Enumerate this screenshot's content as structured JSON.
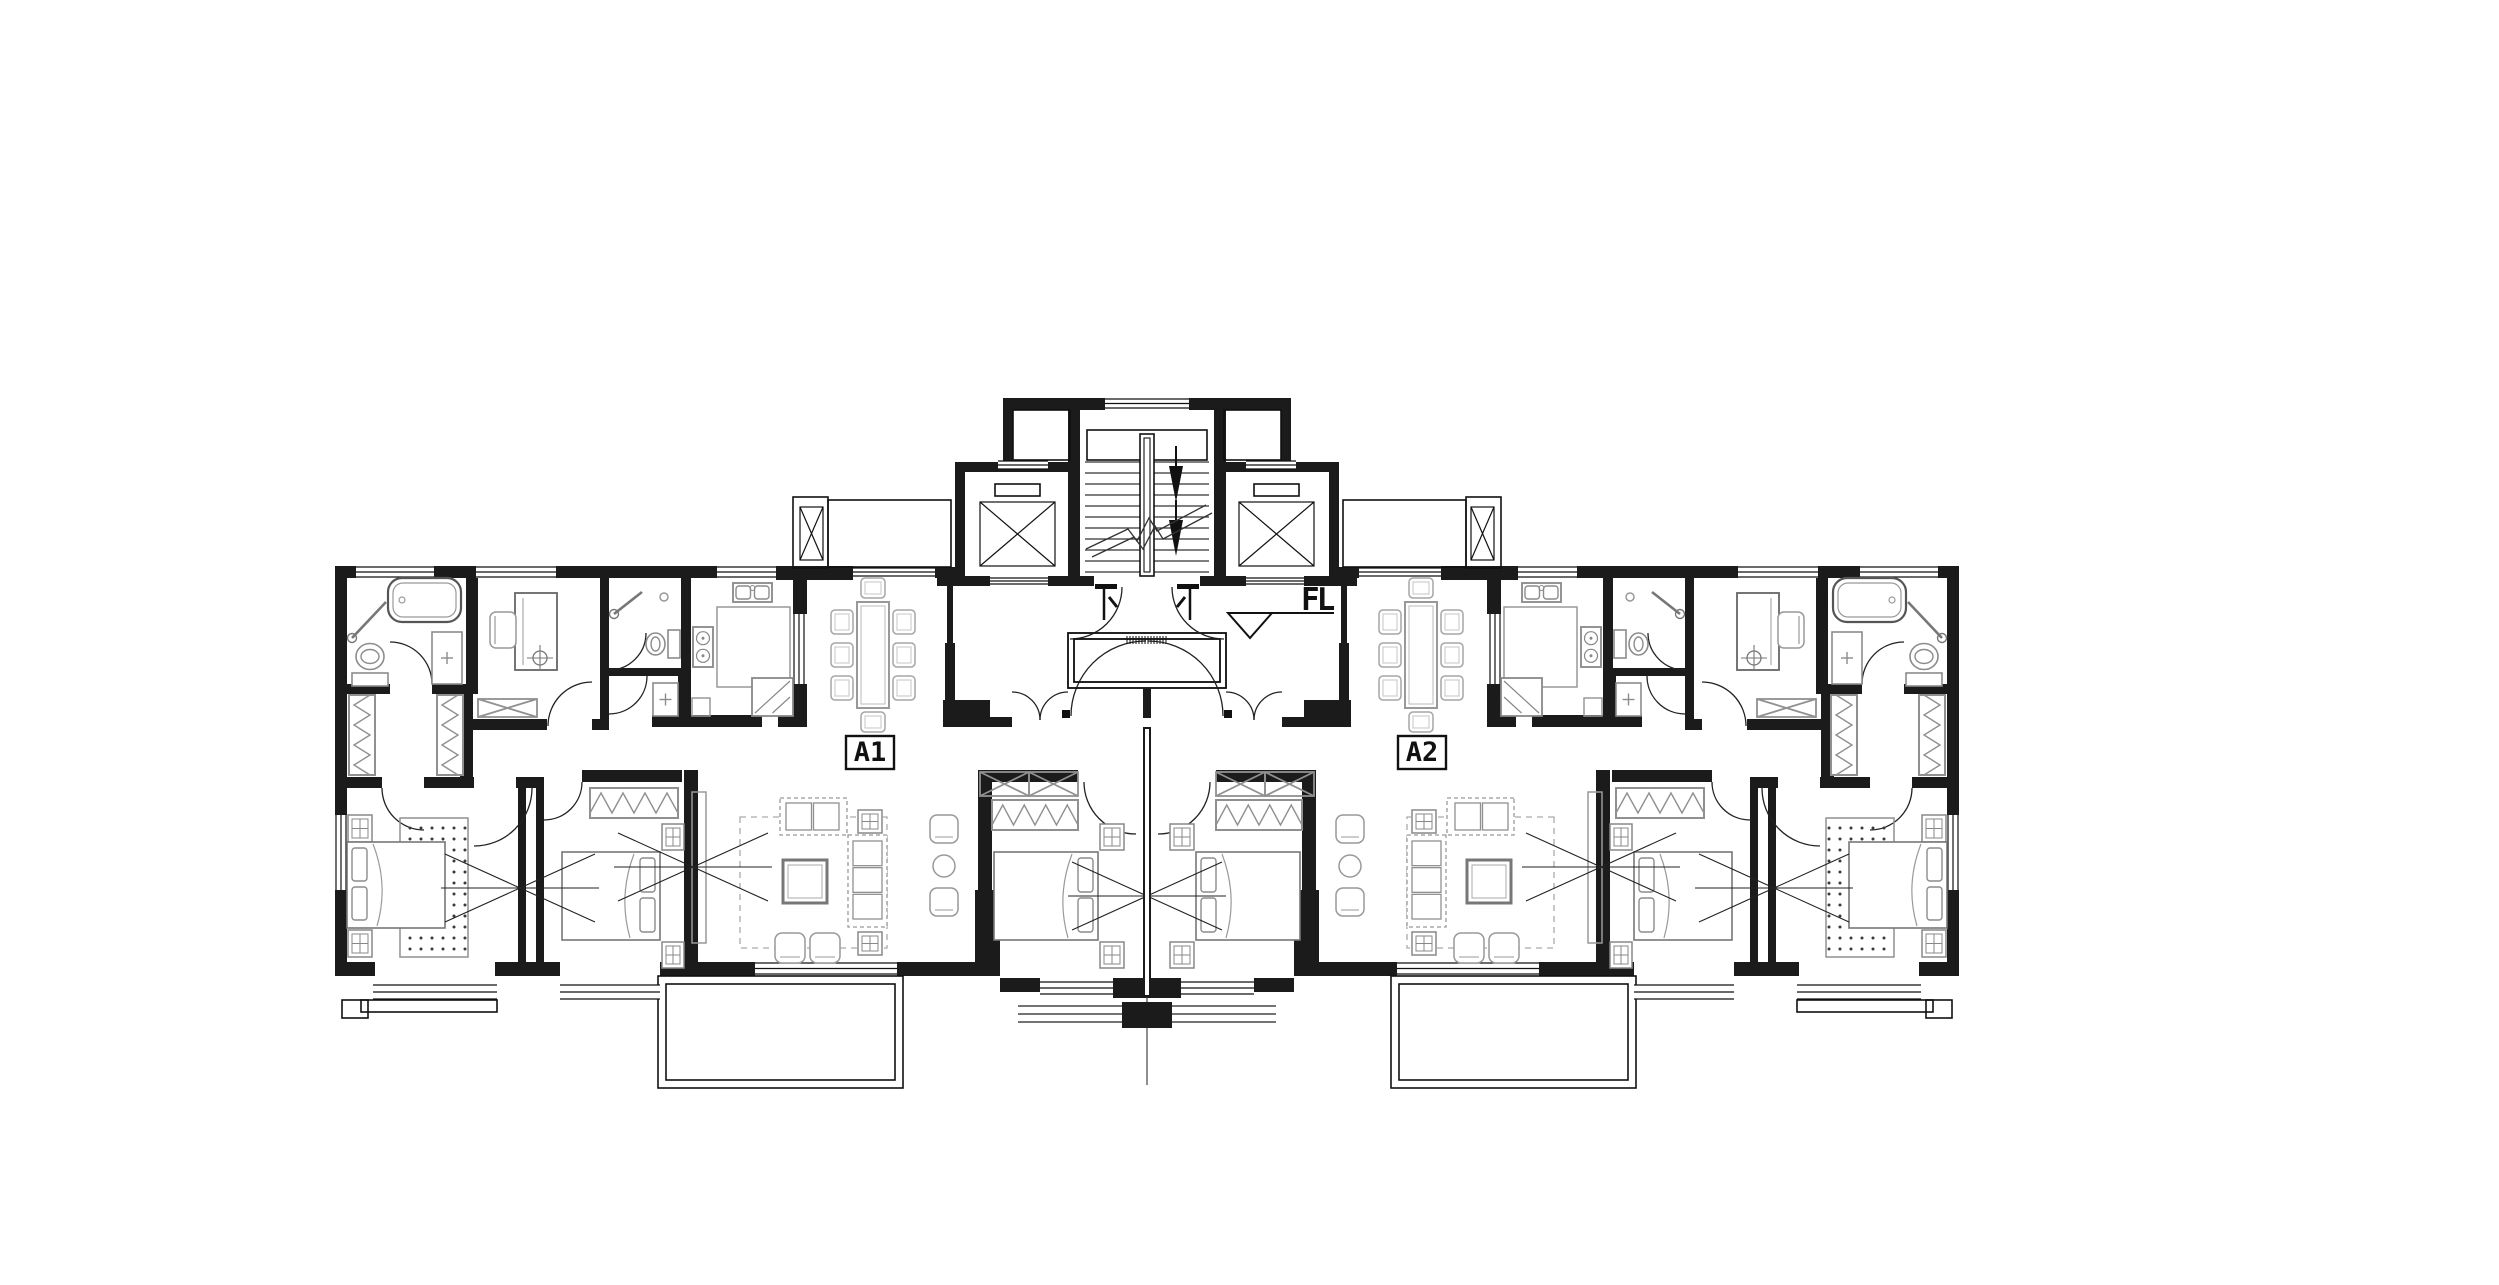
{
  "canvas": {
    "w": 2499,
    "h": 1285
  },
  "labels": {
    "unit_left": "A1",
    "unit_right": "A2",
    "floor_core": "FL"
  },
  "colors": {
    "wall": "#1b1b1b",
    "line": "#111111",
    "furn": "#8c8c8c",
    "furn_dark": "#666666",
    "bg": "#ffffff"
  },
  "plan": {
    "mirror_axis": 1147,
    "walls": [
      [
        335,
        566,
        21,
        12
      ],
      [
        434,
        566,
        42,
        12
      ],
      [
        556,
        566,
        53,
        12
      ],
      [
        609,
        566,
        72,
        12
      ],
      [
        681,
        566,
        36,
        12
      ],
      [
        776,
        566,
        77,
        14
      ],
      [
        935,
        567,
        23,
        11
      ],
      [
        335,
        566,
        12,
        249
      ],
      [
        335,
        890,
        12,
        86
      ],
      [
        466,
        578,
        12,
        116
      ],
      [
        335,
        684,
        55,
        10
      ],
      [
        432,
        684,
        34,
        10
      ],
      [
        460,
        694,
        13,
        94
      ],
      [
        347,
        777,
        35,
        11
      ],
      [
        424,
        777,
        50,
        11
      ],
      [
        516,
        777,
        28,
        11
      ],
      [
        600,
        578,
        9,
        152
      ],
      [
        466,
        719,
        81,
        11
      ],
      [
        592,
        719,
        8,
        11
      ],
      [
        609,
        668,
        72,
        8
      ],
      [
        678,
        676,
        13,
        51
      ],
      [
        652,
        715,
        39,
        12
      ],
      [
        681,
        578,
        10,
        149
      ],
      [
        681,
        715,
        81,
        12
      ],
      [
        793,
        566,
        14,
        48
      ],
      [
        793,
        684,
        14,
        43
      ],
      [
        945,
        717,
        67,
        10
      ],
      [
        943,
        700,
        47,
        27
      ],
      [
        945,
        643,
        10,
        84
      ],
      [
        947,
        586,
        6,
        57
      ],
      [
        937,
        577,
        53,
        9
      ],
      [
        955,
        462,
        123,
        10
      ],
      [
        955,
        576,
        35,
        10
      ],
      [
        1048,
        576,
        30,
        10
      ],
      [
        955,
        462,
        10,
        114
      ],
      [
        1068,
        408,
        12,
        178
      ],
      [
        1003,
        398,
        77,
        12
      ],
      [
        1003,
        398,
        10,
        72
      ],
      [
        1080,
        398,
        25,
        12
      ],
      [
        1068,
        576,
        26,
        10
      ],
      [
        778,
        700,
        27,
        27
      ],
      [
        518,
        782,
        8,
        180
      ],
      [
        536,
        782,
        8,
        180
      ],
      [
        684,
        770,
        14,
        192
      ],
      [
        582,
        770,
        100,
        12
      ],
      [
        978,
        770,
        100,
        12
      ],
      [
        975,
        890,
        25,
        86
      ],
      [
        978,
        782,
        14,
        108
      ],
      [
        335,
        962,
        40,
        14
      ],
      [
        495,
        962,
        65,
        14
      ],
      [
        660,
        962,
        95,
        14
      ],
      [
        897,
        962,
        103,
        14
      ],
      [
        1000,
        978,
        40,
        14
      ],
      [
        1113,
        978,
        38,
        20
      ]
    ],
    "thin_rects": [
      [
        793,
        497,
        35,
        71
      ],
      [
        828,
        500,
        123,
        67
      ],
      [
        1013,
        410,
        57,
        50
      ],
      [
        658,
        976,
        245,
        112
      ],
      [
        666,
        984,
        229,
        96
      ],
      [
        342,
        1000,
        26,
        18
      ],
      [
        361,
        1000,
        136,
        12
      ],
      [
        1068,
        633,
        158,
        55
      ],
      [
        1074,
        639,
        146,
        43
      ],
      [
        995,
        484,
        45,
        12
      ]
    ],
    "xboxes": [
      [
        800,
        507,
        23,
        53,
        0
      ],
      [
        980,
        502,
        75,
        64,
        0
      ],
      [
        478,
        699,
        59,
        18,
        1
      ],
      [
        980,
        772,
        49,
        24,
        1
      ],
      [
        1029,
        772,
        49,
        24,
        1
      ]
    ],
    "windows": [
      [
        356,
        567,
        78,
        10,
        "h"
      ],
      [
        476,
        567,
        80,
        10,
        "h"
      ],
      [
        717,
        567,
        59,
        10,
        "h"
      ],
      [
        853,
        568,
        82,
        8,
        "h"
      ],
      [
        998,
        461,
        50,
        8,
        "h"
      ],
      [
        990,
        578,
        58,
        6,
        "h"
      ],
      [
        794,
        614,
        10,
        70,
        "v"
      ],
      [
        336,
        815,
        10,
        75,
        "v"
      ],
      [
        373,
        985,
        124,
        14,
        "h"
      ],
      [
        560,
        985,
        100,
        14,
        "h"
      ],
      [
        755,
        963,
        142,
        11,
        "h"
      ],
      [
        1040,
        982,
        73,
        12,
        "h"
      ]
    ],
    "door_arcs": [
      [
        390,
        642,
        42,
        432,
        684,
        1
      ],
      [
        382,
        788,
        42,
        424,
        830,
        0
      ],
      [
        532,
        788,
        58,
        474,
        846,
        1
      ],
      [
        544,
        820,
        38,
        582,
        782,
        0
      ],
      [
        548,
        726,
        44,
        592,
        682,
        1
      ],
      [
        646,
        633,
        37,
        609,
        670,
        1
      ],
      [
        647,
        676,
        38,
        609,
        714,
        1
      ],
      [
        1084,
        782,
        52,
        1136,
        834,
        0
      ],
      [
        1122,
        587,
        52,
        1070,
        639,
        1
      ],
      [
        1012,
        692,
        28,
        1040,
        720,
        1
      ],
      [
        1068,
        692,
        28,
        1040,
        720,
        0
      ],
      [
        1071,
        716,
        75,
        1146,
        641,
        1
      ]
    ],
    "furniture": [
      {
        "t": "tub",
        "r": [
          388,
          578,
          73,
          44
        ]
      },
      {
        "t": "shower",
        "p": [
          352,
          638,
          386,
          602
        ]
      },
      {
        "t": "toilet",
        "r": [
          352,
          640,
          36,
          46
        ],
        "o": "s"
      },
      {
        "t": "plusbox",
        "r": [
          432,
          632,
          30,
          52
        ]
      },
      {
        "t": "wardv",
        "r": [
          349,
          695,
          26,
          80
        ]
      },
      {
        "t": "wardv",
        "r": [
          437,
          695,
          26,
          80
        ]
      },
      {
        "t": "desk",
        "r": [
          515,
          593,
          42,
          77
        ]
      },
      {
        "t": "chair",
        "r": [
          490,
          612,
          26,
          36
        ]
      },
      {
        "t": "target",
        "p": [
          540,
          658
        ]
      },
      {
        "t": "shower",
        "p": [
          614,
          614,
          642,
          592
        ]
      },
      {
        "t": "toilet",
        "r": [
          643,
          630,
          37,
          28
        ],
        "o": "e"
      },
      {
        "t": "circle",
        "p": [
          664,
          597,
          4
        ]
      },
      {
        "t": "plusbox",
        "r": [
          653,
          683,
          25,
          33
        ]
      },
      {
        "t": "ksink",
        "r": [
          733,
          583,
          39,
          19
        ]
      },
      {
        "t": "outrect",
        "r": [
          717,
          607,
          73,
          80
        ]
      },
      {
        "t": "stove",
        "r": [
          693,
          627,
          20,
          40
        ]
      },
      {
        "t": "fridge",
        "r": [
          752,
          678,
          41,
          38
        ]
      },
      {
        "t": "outrect",
        "r": [
          692,
          698,
          18,
          18
        ]
      },
      {
        "t": "dining",
        "r": [
          857,
          602,
          32,
          106
        ]
      },
      {
        "t": "outrect",
        "r": [
          692,
          792,
          14,
          151
        ]
      },
      {
        "t": "dashrect",
        "r": [
          740,
          817,
          147,
          131
        ]
      },
      {
        "t": "sofa",
        "r": [
          780,
          798,
          67,
          37
        ],
        "o": "h",
        "n": 2
      },
      {
        "t": "sofa",
        "r": [
          848,
          835,
          39,
          92
        ],
        "o": "v",
        "n": 3
      },
      {
        "t": "nstand",
        "r": [
          858,
          810,
          24,
          23
        ]
      },
      {
        "t": "nstand",
        "r": [
          858,
          932,
          24,
          23
        ]
      },
      {
        "t": "coffee",
        "r": [
          783,
          860,
          44,
          43
        ]
      },
      {
        "t": "stool",
        "r": [
          775,
          933,
          30,
          30
        ]
      },
      {
        "t": "stool",
        "r": [
          810,
          933,
          30,
          30
        ]
      },
      {
        "t": "stool",
        "r": [
          930,
          815,
          28,
          28
        ]
      },
      {
        "t": "stool",
        "r": [
          930,
          888,
          28,
          28
        ]
      },
      {
        "t": "circle",
        "p": [
          944,
          866,
          11
        ]
      },
      {
        "t": "nstand",
        "r": [
          348,
          815,
          24,
          27
        ]
      },
      {
        "t": "nstand",
        "r": [
          348,
          930,
          24,
          27
        ]
      },
      {
        "t": "rug",
        "r": [
          400,
          818,
          68,
          139
        ]
      },
      {
        "t": "bed",
        "r": [
          347,
          842,
          98,
          86
        ],
        "o": "W"
      },
      {
        "t": "wardh",
        "r": [
          590,
          788,
          88,
          30
        ]
      },
      {
        "t": "nstand",
        "r": [
          662,
          824,
          22,
          26
        ]
      },
      {
        "t": "nstand",
        "r": [
          662,
          942,
          22,
          26
        ]
      },
      {
        "t": "bed",
        "r": [
          562,
          852,
          98,
          88
        ],
        "o": "E"
      },
      {
        "t": "wardh",
        "r": [
          992,
          800,
          86,
          30
        ]
      },
      {
        "t": "nstand",
        "r": [
          1100,
          824,
          24,
          26
        ]
      },
      {
        "t": "nstand",
        "r": [
          1100,
          942,
          24,
          26
        ]
      },
      {
        "t": "bed",
        "r": [
          994,
          852,
          104,
          88
        ],
        "o": "E"
      },
      {
        "t": "doorT",
        "p": [
          1104,
          588
        ]
      },
      {
        "t": "sq",
        "r": [
          1062,
          710,
          8,
          8
        ]
      }
    ],
    "center": {
      "window": [
        1105,
        399,
        84,
        9
      ],
      "landing": [
        1087,
        430,
        120,
        30
      ],
      "treads": {
        "x1": 1085,
        "x2": 1209,
        "y0": 462,
        "dy": 11,
        "n": 11
      },
      "handrail": [
        [
          1140,
          434,
          14,
          142
        ],
        [
          1144,
          438,
          6,
          134
        ]
      ],
      "arrows": [
        [
          1176,
          466,
          502
        ],
        [
          1176,
          520,
          556
        ]
      ],
      "breaks": [
        [
          [
            1086,
            549
          ],
          [
            1128,
            529
          ],
          [
            1137,
            541
          ],
          [
            1149,
            518
          ],
          [
            1157,
            531
          ],
          [
            1206,
            505
          ]
        ],
        [
          [
            1092,
            557
          ],
          [
            1134,
            537
          ],
          [
            1143,
            549
          ],
          [
            1155,
            526
          ],
          [
            1163,
            539
          ],
          [
            1212,
            513
          ]
        ]
      ],
      "bowties": [
        [
          520,
          888
        ],
        [
          693,
          867
        ],
        [
          1147,
          896
        ],
        [
          1601,
          867
        ],
        [
          1774,
          888
        ]
      ],
      "bowtie_dim": {
        "arm": 75,
        "spread": 34
      },
      "party_wall": [
        1143,
        727,
        8,
        270
      ],
      "party_line": [
        1147,
        997,
        1147,
        1085
      ],
      "stub": [
        1143,
        688,
        8,
        30
      ],
      "sill": {
        "band": [
          1018,
          1006,
          258,
          16
        ],
        "pier": [
          1122,
          1002,
          50,
          26
        ]
      },
      "hatch": {
        "x1": 1127,
        "x2": 1167,
        "y1": 636,
        "y2": 644,
        "step": 3
      },
      "triangle": {
        "pts": [
          [
            1228,
            613
          ],
          [
            1272,
            613
          ],
          [
            1250,
            638
          ]
        ],
        "tail": [
          1272,
          613,
          1334,
          613
        ]
      }
    },
    "label_boxes": {
      "a1": [
        846,
        736,
        48,
        33
      ],
      "a2": [
        1398,
        736,
        48,
        33
      ],
      "fl_pos": [
        1301,
        610
      ]
    }
  }
}
